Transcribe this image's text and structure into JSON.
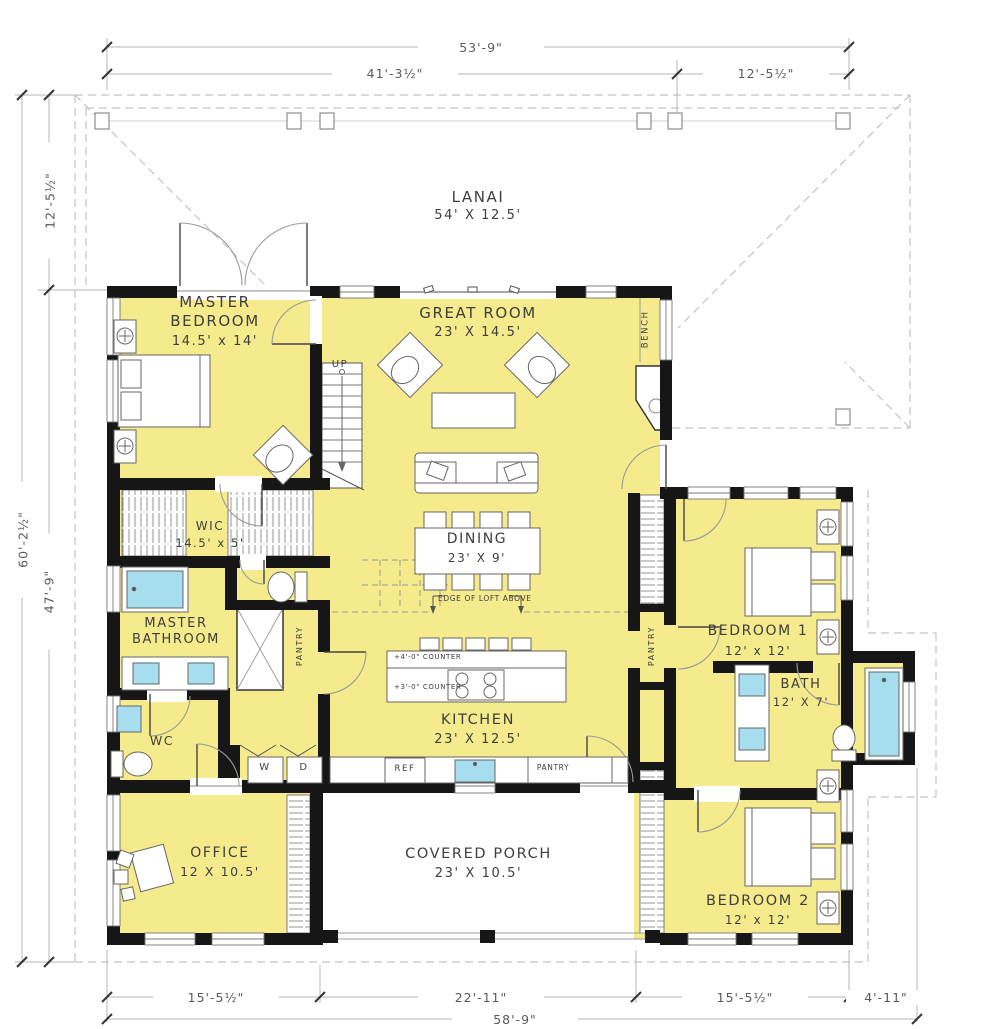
{
  "drawing": {
    "title": "Single story farmhouse floor plan"
  },
  "colors": {
    "room_fill": "#F5EA8C",
    "fixture_blue": "#A6DEF0",
    "wall": "#161616",
    "dimension_line": "#b5b5b5"
  },
  "rooms": {
    "lanai": {
      "name": "LANAI",
      "size": "54' X 12.5'"
    },
    "master_bedroom": {
      "name": "MASTER BEDROOM",
      "size": "14.5' x 14'"
    },
    "great_room": {
      "name": "GREAT ROOM",
      "size": "23' X 14.5'"
    },
    "wic": {
      "name": "WIC",
      "size": "14.5' x 5'"
    },
    "dining": {
      "name": "DINING",
      "size": "23' X 9'"
    },
    "master_bathroom": {
      "name": "MASTER BATHROOM",
      "size": ""
    },
    "bedroom_1": {
      "name": "BEDROOM 1",
      "size": "12' x 12'"
    },
    "bath": {
      "name": "BATH",
      "size": "12' X 7'"
    },
    "kitchen": {
      "name": "KITCHEN",
      "size": "23' X 12.5'"
    },
    "wc": {
      "name": "WC",
      "size": ""
    },
    "office": {
      "name": "OFFICE",
      "size": "12 X 10.5'"
    },
    "covered_porch": {
      "name": "COVERED PORCH",
      "size": "23' X 10.5'"
    },
    "bedroom_2": {
      "name": "BEDROOM 2",
      "size": "12' x 12'"
    }
  },
  "annotations": {
    "up": "UP",
    "bench": "BENCH",
    "pantry_master": "PANTRY",
    "pantry_hall": "PANTRY",
    "pantry_kitchen": "PANTRY",
    "washer": "W",
    "dryer": "D",
    "fridge": "REF",
    "counter_upper": "+4'-0\" COUNTER",
    "counter_lower": "+3'-0\" COUNTER",
    "loft_edge": "EDGE OF LOFT ABOVE"
  },
  "dimensions": {
    "top_total": "53'-9\"",
    "top_left": "41'-3½\"",
    "top_right": "12'-5½\"",
    "left_upper": "12'-5½\"",
    "left_total": "60'-2½\"",
    "left_lower": "47'-9\"",
    "bottom_1": "15'-5½\"",
    "bottom_2": "22'-11\"",
    "bottom_3": "15'-5½\"",
    "bottom_4": "4'-11\"",
    "bottom_total": "58'-9\""
  }
}
